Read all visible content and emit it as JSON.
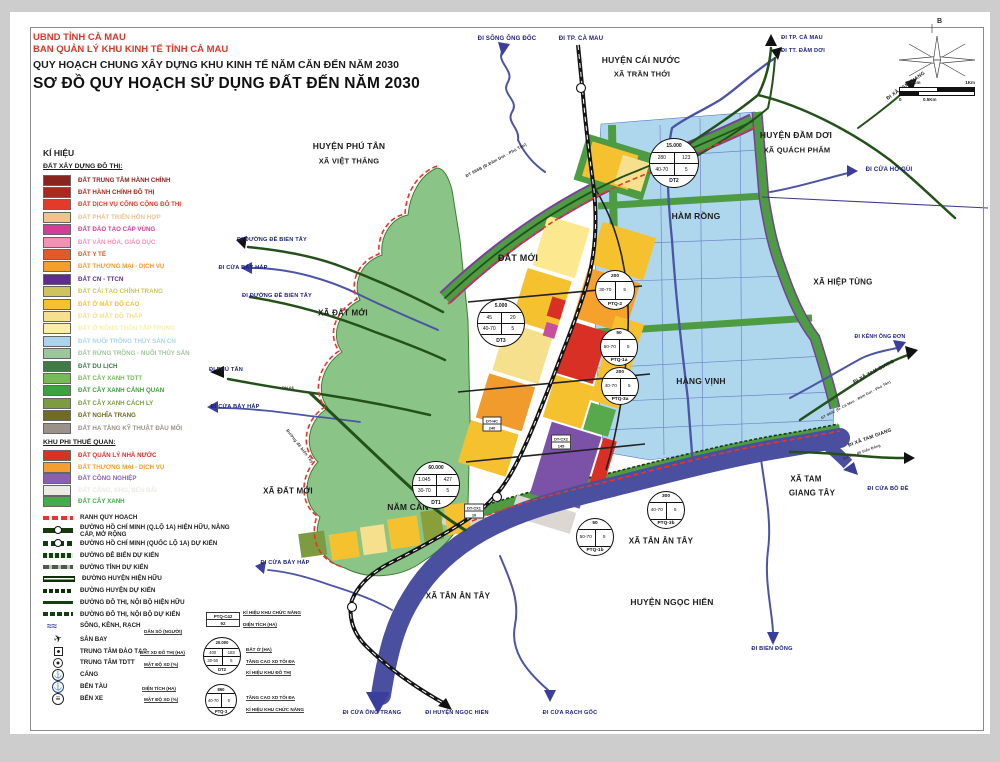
{
  "title": {
    "line1": "UBND TỈNH CÀ MAU",
    "line2": "BAN QUẢN LÝ KHU KINH TẾ TỈNH CÀ MAU",
    "line3": "QUY HOẠCH CHUNG XÂY DỰNG KHU KINH TẾ NĂM CĂN ĐẾN NĂM 2030",
    "line4": "SƠ ĐỒ QUY HOẠCH SỬ DỤNG ĐẤT ĐẾN NĂM 2030"
  },
  "legend": {
    "heading": "KÍ HIỆU",
    "s1_title": "ĐẤT XÂY DỰNG ĐÔ THỊ:",
    "s1": [
      {
        "label": "ĐẤT TRUNG TÂM HÀNH CHÍNH",
        "color": "#8a241e"
      },
      {
        "label": "ĐẤT HÀNH CHÍNH ĐÔ THỊ",
        "color": "#a62a20"
      },
      {
        "label": "ĐẤT DỊCH VỤ CÔNG CỘNG ĐÔ THỊ",
        "color": "#e23b2a"
      },
      {
        "label": "ĐẤT PHÁT TRIỂN HỖN HỢP",
        "color": "#efc28e"
      },
      {
        "label": "ĐẤT ĐÀO TẠO CẤP VÙNG",
        "color": "#cf3f96"
      },
      {
        "label": "ĐẤT VĂN HÓA, GIÁO DỤC",
        "color": "#f391b5"
      },
      {
        "label": "ĐẤT Y TẾ",
        "color": "#e05a2d"
      },
      {
        "label": "ĐẤT THƯƠNG MẠI - DỊCH VỤ",
        "color": "#f59e2f"
      },
      {
        "label": "ĐẤT CN - TTCN",
        "color": "#5e2c8f"
      },
      {
        "label": "ĐẤT CẢI TẠO CHỈNH TRANG",
        "color": "#cdc45e"
      },
      {
        "label": "ĐẤT Ở MẬT ĐỘ CAO",
        "color": "#f5c12f"
      },
      {
        "label": "ĐẤT Ở MẬT ĐỘ THẤP",
        "color": "#f6df8d"
      },
      {
        "label": "ĐẤT Ở NÔNG THÔN TẬP TRUNG",
        "color": "#fbeea6"
      },
      {
        "label": "ĐẤT NUÔI TRỒNG THỦY SẢN CN",
        "color": "#abd4ec"
      },
      {
        "label": "ĐẤT RỪNG TRỒNG - NUÔI THỦY SẢN",
        "color": "#9cc79a"
      },
      {
        "label": "ĐẤT DU LỊCH",
        "color": "#3c7c45"
      },
      {
        "label": "ĐẤT CÂY XANH TDTT",
        "color": "#77bb58"
      },
      {
        "label": "ĐẤT CÂY XANH CẢNH QUAN",
        "color": "#3da23d"
      },
      {
        "label": "ĐẤT CÂY XANH CÁCH LY",
        "color": "#7d9b40"
      },
      {
        "label": "ĐẤT NGHĨA TRANG",
        "color": "#6f6b22"
      },
      {
        "label": "ĐẤT HẠ TẦNG KỸ THUẬT ĐẦU MỐI",
        "color": "#9a9189"
      }
    ],
    "s2_title": "KHU PHI THUẾ QUAN:",
    "s2": [
      {
        "label": "ĐẤT QUẢN LÝ NHÀ NƯỚC",
        "color": "#da3125"
      },
      {
        "label": "ĐẤT THƯƠNG MẠI - DỊCH VỤ",
        "color": "#f59e2f"
      },
      {
        "label": "ĐẤT CÔNG NGHIỆP",
        "color": "#8a5fb2"
      },
      {
        "label": "ĐẤT CẢNG, KHO, BẾN BÃI",
        "color": "#eceae4"
      },
      {
        "label": "ĐẤT CÂY XANH",
        "color": "#44ad4a"
      }
    ],
    "lines": [
      {
        "label": "RANH QUY HOẠCH",
        "style": "sw-ranh"
      },
      {
        "label": "ĐƯỜNG HỒ CHÍ MINH (Q.LỘ 1A) HIỆN HỮU, NÂNG CẤP, MỞ RỘNG",
        "style": "sw-hcm-e"
      },
      {
        "label": "ĐƯỜNG HỒ CHÍ MINH (QUỐC LỘ 1A) DỰ KIẾN",
        "style": "sw-hcm-p"
      },
      {
        "label": "ĐƯỜNG ĐÊ BIỂN DỰ KIẾN",
        "style": "sw-dike"
      },
      {
        "label": "ĐƯỜNG TỈNH DỰ KIẾN",
        "style": "sw-prov"
      },
      {
        "label": "ĐƯỜNG HUYỆN HIỆN HỮU",
        "style": "sw-dist-e"
      },
      {
        "label": "ĐƯỜNG HUYỆN DỰ KIẾN",
        "style": "sw-dist-p"
      },
      {
        "label": "ĐƯỜNG ĐÔ THỊ, NỘI BỘ HIỆN HỮU",
        "style": "sw-urb-e"
      },
      {
        "label": "ĐƯỜNG ĐÔ THỊ, NỘI BỘ DỰ KIẾN",
        "style": "sw-urb-p"
      },
      {
        "label": "SÔNG, KÊNH, RẠCH",
        "style": "sw-river"
      }
    ],
    "points": [
      {
        "label": "SÂN BAY",
        "icon": "ic-plane"
      },
      {
        "label": "TRUNG TÂM ĐÀO TẠO",
        "icon": "ic-square"
      },
      {
        "label": "TRUNG TÂM TDTT",
        "icon": "ic-circsq"
      },
      {
        "label": "CẢNG",
        "icon": "ic-anchor"
      },
      {
        "label": "BẾN TÀU",
        "icon": "ic-dock"
      },
      {
        "label": "BẾN XE",
        "icon": "ic-bus"
      }
    ]
  },
  "callouts": {
    "box": {
      "l1": "PTQ-C42",
      "l2": "92"
    },
    "k1": "KÍ HIỆU KHU CHỨC NĂNG",
    "k2": "DIỆN TÍCH (HA)",
    "l1": "DÂN SỐ (NGƯỜI)",
    "l2": "ĐẤT XD ĐÔ THỊ (HA)",
    "l3": "MẬT ĐỘ XD (%)",
    "r1": "ĐẤT Ở (HA)",
    "r2": "TẦNG CAO XD TỐI ĐA",
    "r3": "KÍ HIỆU KHU ĐÔ THỊ",
    "l4": "DIỆN TÍCH (HA)",
    "l5": "MẬT ĐỘ XD (%)",
    "r4": "TẦNG CAO XD TỐI ĐA",
    "r5": "KÍ HIỆU KHU CHỨC NĂNG",
    "circles": [
      {
        "name": "DT2",
        "x": 221,
        "y": 655,
        "r": 18,
        "top": "20.000",
        "rows": [
          [
            "400",
            "183"
          ],
          [
            "30-50",
            "5"
          ]
        ],
        "fs": 4.2
      },
      {
        "name": "PTQ-3",
        "x": 220,
        "y": 699,
        "r": 15,
        "top": "860",
        "rows": [
          [
            "40-70",
            "5"
          ]
        ],
        "fs": 4.2
      }
    ]
  },
  "compass": {
    "north": "B"
  },
  "scalebar": {
    "tl": "0.5Km",
    "tr": "1Km",
    "bl": "0",
    "bm": "0.5Km"
  },
  "map": {
    "labels": [
      {
        "text": "ĐI SÔNG ÔNG ĐỐC",
        "x": 507,
        "y": 39,
        "size": 6,
        "color": "#1a1f7a"
      },
      {
        "text": "ĐI TP. CÀ MAU",
        "x": 581,
        "y": 39,
        "size": 6,
        "color": "#1a1f7a"
      },
      {
        "text": "HUYỆN CÁI NƯỚC",
        "x": 641,
        "y": 60,
        "size": 8.5
      },
      {
        "text": "XÃ TRẦN THỚI",
        "x": 642,
        "y": 74,
        "size": 7.5
      },
      {
        "text": "ĐI TP. CÀ MAU",
        "x": 802,
        "y": 38,
        "size": 5.6,
        "color": "#1a1f7a"
      },
      {
        "text": "ĐI TT. ĐẦM DƠI",
        "x": 803,
        "y": 51,
        "size": 5.6,
        "color": "#1a1f7a"
      },
      {
        "text": "ĐI XÃ TAM GIANG",
        "x": 906,
        "y": 86,
        "size": 5,
        "rot": -35
      },
      {
        "text": "HUYỆN ĐẦM DƠI",
        "x": 796,
        "y": 135,
        "size": 8.5
      },
      {
        "text": "XÃ QUÁCH PHẨM",
        "x": 797,
        "y": 150,
        "size": 7.5
      },
      {
        "text": "ĐI CỬA HỐ GÙI",
        "x": 889,
        "y": 170,
        "size": 6,
        "color": "#1a1f7a"
      },
      {
        "text": "HUYỆN PHÚ TÂN",
        "x": 349,
        "y": 146,
        "size": 8.5
      },
      {
        "text": "XÃ VIỆT THẮNG",
        "x": 349,
        "y": 161,
        "size": 7.5
      },
      {
        "text": "ĐT 986B (Đ.Đầm Dơi - Phú Tân)",
        "x": 496,
        "y": 160,
        "size": 4.2,
        "rot": -28,
        "color": "#333333"
      },
      {
        "text": "ĐẤT MỚI",
        "x": 518,
        "y": 258,
        "size": 9
      },
      {
        "text": "HÀM RỒNG",
        "x": 696,
        "y": 216,
        "size": 8.5
      },
      {
        "text": "XÃ HIỆP TÙNG",
        "x": 843,
        "y": 282,
        "size": 8
      },
      {
        "text": "ĐI ĐƯỜNG ĐÊ BIỂN TÂY",
        "x": 272,
        "y": 240,
        "size": 5.6,
        "color": "#1a1f7a"
      },
      {
        "text": "ĐI CỬA BẢY HÁP",
        "x": 243,
        "y": 268,
        "size": 5.6,
        "color": "#1a1f7a"
      },
      {
        "text": "ĐI ĐƯỜNG ĐÊ BIỂN TÂY",
        "x": 277,
        "y": 296,
        "size": 5.6,
        "color": "#1a1f7a"
      },
      {
        "text": "XÃ ĐẤT MỚI",
        "x": 343,
        "y": 313,
        "size": 8
      },
      {
        "text": "ĐI KÊNH ÔNG ĐƠN",
        "x": 880,
        "y": 337,
        "size": 5.2,
        "color": "#1a1f7a"
      },
      {
        "text": "ĐI XÃ TAM GIANG",
        "x": 874,
        "y": 372,
        "size": 5,
        "rot": -28
      },
      {
        "text": "ĐT 990C (Đ. Cà Mau - Đầm Dơi - Phú Tân)",
        "x": 856,
        "y": 400,
        "size": 3.6,
        "rot": -28,
        "color": "#333333"
      },
      {
        "text": "HÀNG VỊNH",
        "x": 701,
        "y": 381,
        "size": 8.5
      },
      {
        "text": "ĐI PHÚ TÂN",
        "x": 226,
        "y": 370,
        "size": 5.6,
        "color": "#1a1f7a"
      },
      {
        "text": "ĐI CỬA BẢY HÁP",
        "x": 235,
        "y": 407,
        "size": 5.6,
        "color": "#1a1f7a"
      },
      {
        "text": "Đường đê biển Tây",
        "x": 300,
        "y": 446,
        "size": 4.2,
        "rot": 52,
        "color": "#333333"
      },
      {
        "text": "XÃ ĐẤT MỚI",
        "x": 288,
        "y": 491,
        "size": 8
      },
      {
        "text": "NĂM CĂN",
        "x": 408,
        "y": 507,
        "size": 8.5
      },
      {
        "text": "XÃ TAM",
        "x": 806,
        "y": 479,
        "size": 8
      },
      {
        "text": "GIANG TÂY",
        "x": 812,
        "y": 493,
        "size": 8
      },
      {
        "text": "ĐI XÃ TAM GIANG",
        "x": 870,
        "y": 438,
        "size": 5,
        "rot": -20
      },
      {
        "text": "Đường đê biển Đông",
        "x": 862,
        "y": 452,
        "size": 3.6,
        "rot": -20,
        "color": "#333333"
      },
      {
        "text": "ĐI CỬA BỒ ĐỀ",
        "x": 888,
        "y": 489,
        "size": 5.6,
        "color": "#1a1f7a"
      },
      {
        "text": "XÃ TÂN ÂN TÂY",
        "x": 661,
        "y": 541,
        "size": 8
      },
      {
        "text": "XÃ TÂN ÂN TÂY",
        "x": 458,
        "y": 596,
        "size": 8
      },
      {
        "text": "HUYỆN NGỌC HIỂN",
        "x": 672,
        "y": 602,
        "size": 8.5
      },
      {
        "text": "ĐI CỬA BẢY HÁP",
        "x": 285,
        "y": 563,
        "size": 5.6,
        "color": "#1a1f7a"
      },
      {
        "text": "ĐI CỬA ÔNG TRANG",
        "x": 372,
        "y": 713,
        "size": 5.6,
        "color": "#1a1f7a"
      },
      {
        "text": "ĐI HUYỆN NGỌC HIỂN",
        "x": 457,
        "y": 713,
        "size": 5.6,
        "color": "#1a1f7a"
      },
      {
        "text": "ĐI CỬA RẠCH GỐC",
        "x": 570,
        "y": 713,
        "size": 5.6,
        "color": "#1a1f7a"
      },
      {
        "text": "ĐI BIỂN ĐÔNG",
        "x": 772,
        "y": 649,
        "size": 5.6,
        "color": "#1a1f7a"
      },
      {
        "text": "ĐH.06",
        "x": 288,
        "y": 388,
        "size": 3.8,
        "color": "#333333"
      }
    ],
    "circles": [
      {
        "name": "DT2",
        "x": 673,
        "y": 162,
        "r": 24,
        "top": "15.000",
        "rows": [
          [
            "280",
            "123"
          ],
          [
            "40-70",
            "5"
          ]
        ],
        "fs": 5
      },
      {
        "name": "DT3",
        "x": 500,
        "y": 322,
        "r": 23,
        "top": "5.000",
        "rows": [
          [
            "45",
            "20"
          ],
          [
            "40-70",
            "5"
          ]
        ],
        "fs": 5
      },
      {
        "name": "DT1",
        "x": 435,
        "y": 484,
        "r": 23,
        "top": "60.000",
        "rows": [
          [
            "1.045",
            "427"
          ],
          [
            "30-70",
            "5"
          ]
        ],
        "fs": 5
      },
      {
        "name": "PTQ-2",
        "x": 614,
        "y": 289,
        "r": 19,
        "top": "200",
        "rows": [
          [
            "30-70",
            "5"
          ]
        ],
        "fs": 4.8
      },
      {
        "name": "PTQ-1a",
        "x": 618,
        "y": 346,
        "r": 18,
        "top": "50",
        "rows": [
          [
            "50-70",
            "5"
          ]
        ],
        "fs": 4.8
      },
      {
        "name": "PTQ-3a",
        "x": 619,
        "y": 385,
        "r": 18,
        "top": "200",
        "rows": [
          [
            "40-70",
            "5"
          ]
        ],
        "fs": 4.8
      },
      {
        "name": "PTQ-3b",
        "x": 665,
        "y": 509,
        "r": 18,
        "top": "300",
        "rows": [
          [
            "40-70",
            "5"
          ]
        ],
        "fs": 4.8
      },
      {
        "name": "PTQ-1b",
        "x": 594,
        "y": 536,
        "r": 18,
        "top": "50",
        "rows": [
          [
            "50-70",
            "5"
          ]
        ],
        "fs": 4.8
      }
    ],
    "boxes": [
      {
        "l1": "DT-HC",
        "l2": "240",
        "x": 492,
        "y": 424
      },
      {
        "l1": "DT-CX2",
        "l2": "145",
        "x": 561,
        "y": 442
      },
      {
        "l1": "DT-CX1",
        "l2": "10",
        "x": 474,
        "y": 511
      }
    ]
  },
  "colors": {
    "accent_red": "#d23a2a",
    "navy_route": "#1a1f7a",
    "river_wide": "#4b4f9f",
    "aquaculture_blue": "#aed7ee",
    "forest_green": "#8ac587",
    "road_green": "#24511a",
    "boundary_red": "#e3372b",
    "boundary_purple": "#7a3f98"
  }
}
